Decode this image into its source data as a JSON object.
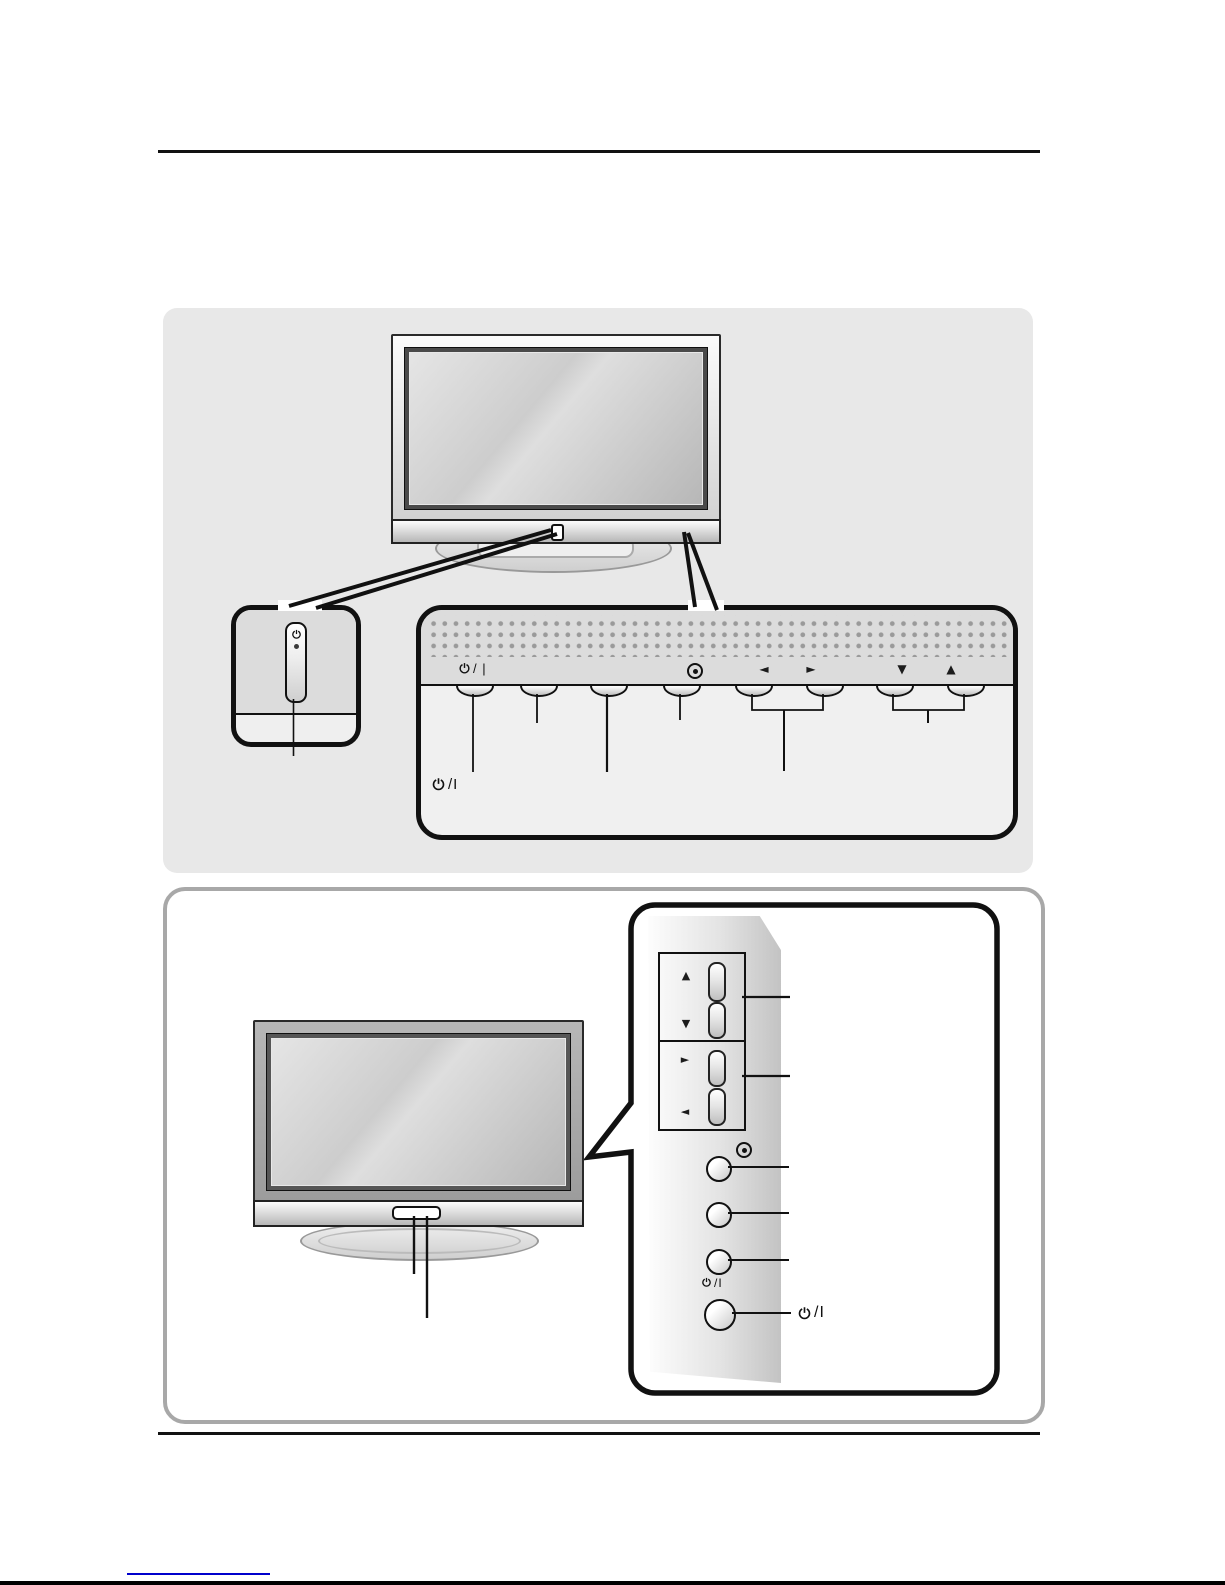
{
  "colors": {
    "section_background": "#e8e8e8",
    "panel_dot_gray": "#9a9a9a",
    "outline_black": "#111111",
    "box_border_gray": "#a8a8a8",
    "link_blue": "#0000cc"
  },
  "front_panel": {
    "power_label": "/ |",
    "power_label_bottom": "/I",
    "arrow_left": "◄",
    "arrow_right": "►",
    "arrow_down": "▼",
    "arrow_up": "▲"
  },
  "side_panel": {
    "arrow_up": "▲",
    "arrow_down": "▼",
    "arrow_right": "►",
    "arrow_left": "◄",
    "power_label_small": "/I",
    "power_label_callout": "/I"
  },
  "icons": {
    "power": "power-icon",
    "ok_dot": "ok-dot-icon",
    "status_led": "led-icon",
    "remote_sensor": "sensor-window"
  }
}
